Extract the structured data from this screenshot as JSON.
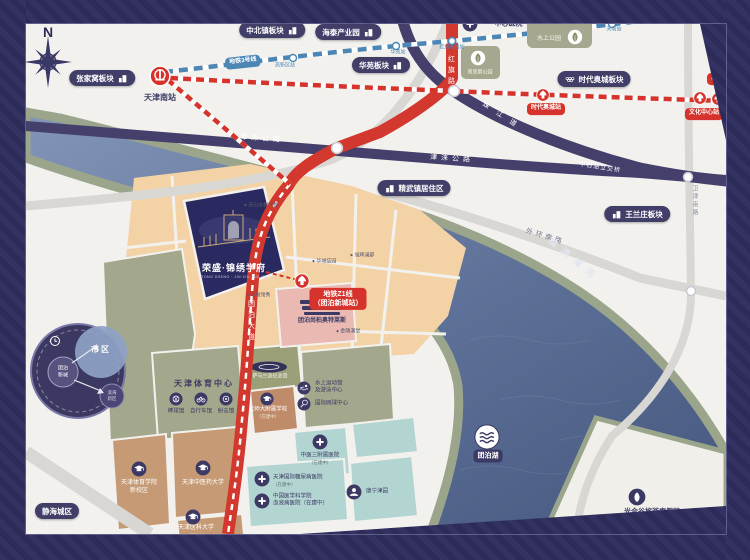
{
  "project": {
    "name": "荣盛·锦绣学府",
    "subtitle": "RONG SHENG · JIN XIU XUE FU"
  },
  "colors": {
    "accent_red": "#d5332b",
    "navy": "#3c3a64",
    "metro_blue": "#4c86b4",
    "parcel_tan": "#f3d3a6",
    "parcel_sage": "#a3a78c",
    "parcel_teal": "#b2d5d2",
    "parcel_brown": "#c59a74",
    "outlet_pink": "#e9b9b2",
    "water": "#5c6f94"
  },
  "pills": [
    {
      "id": "pill-zhangjiawo",
      "t": "张家窝板块",
      "x": 102,
      "y": 78,
      "icon": "building",
      "side": "r"
    },
    {
      "id": "pill-zhongbeizhen",
      "t": "中北镇板块",
      "x": 272,
      "y": 30,
      "icon": "building",
      "side": "r"
    },
    {
      "id": "pill-haitai",
      "t": "海泰产业园",
      "x": 348,
      "y": 32,
      "icon": "building",
      "side": "r"
    },
    {
      "id": "pill-huayuan",
      "t": "华苑板块",
      "x": 381,
      "y": 65,
      "icon": "building",
      "side": "r"
    },
    {
      "id": "pill-shidai-aocheng",
      "t": "时代奥城板块",
      "x": 594,
      "y": 79,
      "icon": "rings",
      "side": "l"
    },
    {
      "id": "pill-jingwuzhen",
      "t": "精武镇居住区",
      "x": 414,
      "y": 188,
      "icon": "building",
      "side": "l"
    },
    {
      "id": "pill-wanglanzhuang",
      "t": "王兰庄板块",
      "x": 637,
      "y": 214,
      "icon": "building",
      "side": "l"
    },
    {
      "id": "pill-jinghai-chengqu",
      "t": "静海城区",
      "x": 57,
      "y": 511,
      "icon": null,
      "side": "l"
    }
  ],
  "badges": [
    {
      "id": "badge-z1-line",
      "lines": [
        "地铁Z1线",
        "（团泊新城站）"
      ],
      "x": 338,
      "y": 299,
      "fs": 7
    },
    {
      "id": "badge-shidai-aocheng-station",
      "lines": [
        "时代奥城站"
      ],
      "x": 546,
      "y": 109,
      "fs": 6
    },
    {
      "id": "badge-wenhua-zhongxin-station",
      "lines": [
        "文化中心站"
      ],
      "x": 704,
      "y": 114,
      "fs": 6
    },
    {
      "id": "badge-tucheng-station",
      "lines": [
        "土城站"
      ],
      "x": 720,
      "y": 79,
      "fs": 6
    },
    {
      "id": "badge-line3",
      "lines": [
        "地铁3号线"
      ],
      "x": 243,
      "y": 62,
      "fs": 6,
      "bg": "#4c86b4",
      "rot": -6
    },
    {
      "id": "badge-tuanbo-lake",
      "lines": [
        "团泊湖"
      ],
      "x": 488,
      "y": 456,
      "fs": 7,
      "bg": "#3c3a64"
    }
  ],
  "labels": [
    {
      "id": "compass-n",
      "t": "N",
      "x": 48,
      "y": 32,
      "fs": 14,
      "c": "#2f2d58",
      "b": 1
    },
    {
      "id": "tianjin-south-station",
      "t": "天津南站",
      "x": 160,
      "y": 98,
      "fs": 8,
      "c": "#3c3a64",
      "b": 1
    },
    {
      "id": "road-jinlai-1",
      "t": "津涞公路",
      "x": 262,
      "y": 139,
      "fs": 7,
      "c": "#ffffff",
      "rot": 4,
      "ls": 4
    },
    {
      "id": "road-jinlai-2",
      "t": "津涞公路",
      "x": 452,
      "y": 159,
      "fs": 7,
      "c": "#ffffff",
      "rot": 4,
      "ls": 4
    },
    {
      "id": "road-zhujiang",
      "t": "珠江道",
      "x": 503,
      "y": 117,
      "fs": 7,
      "c": "#ffffff",
      "rot": 33,
      "ls": 9
    },
    {
      "id": "road-hongqi",
      "t": "红旗路",
      "x": 451,
      "y": 55,
      "fs": 7,
      "c": "#ffffff",
      "v": 1,
      "ls": 4
    },
    {
      "id": "road-tuanbo-dadao",
      "t": "团泊大道",
      "x": 251,
      "y": 300,
      "fs": 7,
      "c": "#ffffff",
      "v": 1,
      "ls": 4
    },
    {
      "id": "bridge-zhongshiyou",
      "t": "中石油立交桥",
      "x": 600,
      "y": 168,
      "fs": 6,
      "c": "#ffffff",
      "rot": 9,
      "ls": 1
    },
    {
      "id": "road-waihuan-south",
      "t": "外环南路",
      "x": 545,
      "y": 237,
      "fs": 7,
      "c": "#73738a",
      "rot": 17,
      "ls": 3
    },
    {
      "id": "road-weijin-south",
      "t": "卫津南路",
      "x": 694,
      "y": 185,
      "fs": 6,
      "c": "#9093a0",
      "v": 1,
      "ls": 2
    },
    {
      "id": "river-duliujian",
      "t": "独流减河",
      "x": 574,
      "y": 260,
      "fs": 9,
      "c": "#e2e6f2",
      "rot": 40,
      "ls": 7,
      "b": 1
    },
    {
      "id": "hospital-yizhongxin",
      "t": "一中心医院",
      "x": 505,
      "y": 24,
      "fs": 7,
      "c": "#3c3a64",
      "b": 1
    },
    {
      "id": "park-shuishang",
      "t": "水上公园",
      "x": 549,
      "y": 39,
      "fs": 6,
      "c": "#f5f5ea"
    },
    {
      "id": "park-nancuiping",
      "t": "南翠屏公园",
      "x": 480,
      "y": 73,
      "fs": 5,
      "c": "#f5f5ea"
    },
    {
      "id": "station-gaoxinqu",
      "t": "高新区站",
      "x": 285,
      "y": 66,
      "fs": 5,
      "c": "#4c86b4"
    },
    {
      "id": "station-huayuan",
      "t": "华苑站",
      "x": 398,
      "y": 53,
      "fs": 5,
      "c": "#4c86b4"
    },
    {
      "id": "station-hongqinanlu",
      "t": "红旗南路站",
      "x": 452,
      "y": 48,
      "fs": 5,
      "c": "#4c86b4"
    },
    {
      "id": "station-tianta",
      "t": "天塔站",
      "x": 614,
      "y": 30,
      "fs": 5,
      "c": "#4c86b4"
    },
    {
      "id": "community-1",
      "t": "● 天山水榭花都",
      "x": 244,
      "y": 206,
      "fs": 5,
      "c": "#5c5c6e",
      "a": 1
    },
    {
      "id": "community-2",
      "t": "● 华城佶园",
      "x": 312,
      "y": 262,
      "fs": 5,
      "c": "#5c5c6e",
      "a": 1
    },
    {
      "id": "community-3",
      "t": "● 旭辉澜郡",
      "x": 350,
      "y": 256,
      "fs": 5,
      "c": "#5c5c6e",
      "a": 1
    },
    {
      "id": "community-4",
      "t": "● 华城领秀",
      "x": 246,
      "y": 296,
      "fs": 5,
      "c": "#5c5c6e",
      "a": 1
    },
    {
      "id": "community-5",
      "t": "● 金隅满堂",
      "x": 336,
      "y": 332,
      "fs": 5,
      "c": "#5c5c6e",
      "a": 1
    },
    {
      "id": "sports-center-title",
      "t": "天津体育中心",
      "x": 204,
      "y": 384,
      "fs": 8,
      "c": "#3c3a64",
      "b": 1,
      "ls": 2
    },
    {
      "id": "venue-baseball",
      "t": "棒球馆",
      "x": 176,
      "y": 412,
      "fs": 5.5,
      "c": "#3c3a64"
    },
    {
      "id": "venue-cycling",
      "t": "自行车馆",
      "x": 201,
      "y": 412,
      "fs": 5.5,
      "c": "#3c3a64"
    },
    {
      "id": "venue-shooting",
      "t": "射击馆",
      "x": 226,
      "y": 412,
      "fs": 5.5,
      "c": "#3c3a64"
    },
    {
      "id": "venue-samaranch",
      "t": "萨马兰奇纪念馆",
      "x": 270,
      "y": 377,
      "fs": 5,
      "c": "#f2f2ea"
    },
    {
      "id": "venue-aquatic-1",
      "t": "水上运动馆",
      "x": 315,
      "y": 384,
      "fs": 5.5,
      "c": "#3c3a64",
      "a": 1
    },
    {
      "id": "venue-aquatic-2",
      "t": "及游泳中心",
      "x": 315,
      "y": 391,
      "fs": 5.5,
      "c": "#3c3a64",
      "a": 1
    },
    {
      "id": "venue-tennis",
      "t": "国际网球中心",
      "x": 315,
      "y": 404,
      "fs": 5.5,
      "c": "#3c3a64",
      "a": 1
    },
    {
      "id": "school-beishida",
      "t": "北师大附属学校",
      "x": 268,
      "y": 410,
      "fs": 5.5,
      "c": "#ffffff"
    },
    {
      "id": "school-beishida-note",
      "t": "（在建中）",
      "x": 268,
      "y": 417,
      "fs": 4.5,
      "c": "#f0e6da"
    },
    {
      "id": "outlet-label",
      "t": "团泊尚柏奥特莱斯",
      "x": 322,
      "y": 321,
      "fs": 6,
      "c": "#3c3a64",
      "b": 1
    },
    {
      "id": "hospital-zhongyi-3",
      "t": "中医三附属医院",
      "x": 320,
      "y": 456,
      "fs": 5.5,
      "c": "#3c3a64"
    },
    {
      "id": "hospital-zhongyi-3-note",
      "t": "（在建中）",
      "x": 320,
      "y": 463,
      "fs": 4.5,
      "c": "#5d6e76"
    },
    {
      "id": "hospital-tangniaobing",
      "t": "天津国际糖尿病医院",
      "x": 273,
      "y": 478,
      "fs": 5.5,
      "c": "#3c3a64",
      "a": 1
    },
    {
      "id": "hospital-tangniaobing-note",
      "t": "（在建中）",
      "x": 273,
      "y": 485,
      "fs": 4.5,
      "c": "#5d6e76",
      "a": 1
    },
    {
      "id": "hospital-xueyebing-1",
      "t": "中国医学科学院",
      "x": 273,
      "y": 497,
      "fs": 5.5,
      "c": "#3c3a64",
      "a": 1
    },
    {
      "id": "hospital-xueyebing-2",
      "t": "血液病医院（在建中）",
      "x": 273,
      "y": 504,
      "fs": 5.5,
      "c": "#3c3a64",
      "a": 1
    },
    {
      "id": "kangning-jinyuan",
      "t": "康宁津园",
      "x": 366,
      "y": 492,
      "fs": 5.5,
      "c": "#3c3a64",
      "a": 1
    },
    {
      "id": "univ-tiyu-1",
      "t": "天津体育学院",
      "x": 139,
      "y": 483,
      "fs": 6,
      "c": "#ffffff"
    },
    {
      "id": "univ-tiyu-2",
      "t": "新校区",
      "x": 139,
      "y": 491,
      "fs": 6,
      "c": "#ffffff"
    },
    {
      "id": "univ-zhongyiyao",
      "t": "天津中医药大学",
      "x": 203,
      "y": 483,
      "fs": 6,
      "c": "#ffffff"
    },
    {
      "id": "univ-yike",
      "t": "天津医科大学",
      "x": 196,
      "y": 528,
      "fs": 6,
      "c": "#ffffff"
    },
    {
      "id": "univ-yike-note",
      "t": "（规划中）",
      "x": 196,
      "y": 536,
      "fs": 4.5,
      "c": "#efe6dc"
    },
    {
      "id": "guanghegu",
      "t": "光合谷旅游度假区",
      "x": 652,
      "y": 512,
      "fs": 7,
      "c": "#3c3a64",
      "b": 1
    },
    {
      "id": "inset-shiqu",
      "t": "市区",
      "x": 101,
      "y": 350,
      "fs": 8,
      "c": "#ffffff",
      "b": 1,
      "ls": 2
    },
    {
      "id": "inset-tuanbo-1",
      "t": "团泊",
      "x": 63,
      "y": 369,
      "fs": 5,
      "c": "#ffffff"
    },
    {
      "id": "inset-tuanbo-2",
      "t": "新城",
      "x": 63,
      "y": 376,
      "fs": 5,
      "c": "#ffffff"
    },
    {
      "id": "inset-binhai-1",
      "t": "滨海",
      "x": 112,
      "y": 393,
      "fs": 4.5,
      "c": "#dcdcea"
    },
    {
      "id": "inset-binhai-2",
      "t": "新区",
      "x": 112,
      "y": 399,
      "fs": 4.5,
      "c": "#dcdcea"
    }
  ],
  "pois": [
    {
      "id": "tianjin-south-railway-icon",
      "icon": "rail",
      "x": 160,
      "y": 76,
      "r": 11
    },
    {
      "id": "z1-tuanbo-station-icon",
      "icon": "metro",
      "x": 302,
      "y": 281,
      "r": 8
    },
    {
      "id": "aocheng-station-icon",
      "icon": "metro",
      "x": 543,
      "y": 95,
      "r": 7
    },
    {
      "id": "wenhua-station-icon",
      "icon": "metro",
      "x": 700,
      "y": 98,
      "r": 7
    },
    {
      "id": "tucheng-station-icon",
      "icon": "metro",
      "x": 718,
      "y": 99,
      "r": 7
    },
    {
      "id": "yizhongxin-hospital-icon",
      "icon": "cross",
      "x": 470,
      "y": 24,
      "r": 8
    },
    {
      "id": "shuishang-park-icon",
      "icon": "leaf",
      "x": 575,
      "y": 37,
      "r": 8
    },
    {
      "id": "nancuiping-park-icon",
      "icon": "leaf",
      "x": 478,
      "y": 58,
      "r": 8
    },
    {
      "id": "zhongyi3-hospital-icon",
      "icon": "cross",
      "x": 320,
      "y": 442,
      "r": 8
    },
    {
      "id": "tangniaobing-hospital-icon",
      "icon": "cross",
      "x": 262,
      "y": 479,
      "r": 8
    },
    {
      "id": "xueyebing-hospital-icon",
      "icon": "cross",
      "x": 262,
      "y": 501,
      "r": 8
    },
    {
      "id": "kangning-icon",
      "icon": "person",
      "x": 354,
      "y": 492,
      "r": 8
    },
    {
      "id": "univ-tiyu-icon",
      "icon": "cap",
      "x": 139,
      "y": 469,
      "r": 8
    },
    {
      "id": "univ-zhongyiyao-icon",
      "icon": "cap",
      "x": 203,
      "y": 468,
      "r": 8
    },
    {
      "id": "univ-yike-icon",
      "icon": "cap",
      "x": 193,
      "y": 517,
      "r": 8
    },
    {
      "id": "school-beishida-icon",
      "icon": "cap",
      "x": 267,
      "y": 399,
      "r": 7
    },
    {
      "id": "baseball-icon",
      "icon": "ball",
      "x": 176,
      "y": 399,
      "r": 7
    },
    {
      "id": "cycling-icon",
      "icon": "bike",
      "x": 201,
      "y": 399,
      "r": 7
    },
    {
      "id": "shooting-icon",
      "icon": "target",
      "x": 226,
      "y": 399,
      "r": 7
    },
    {
      "id": "aquatic-icon",
      "icon": "swim",
      "x": 304,
      "y": 388,
      "r": 7
    },
    {
      "id": "tennis-icon",
      "icon": "racket",
      "x": 304,
      "y": 404,
      "r": 7
    },
    {
      "id": "tuanbo-lake-icon",
      "icon": "waves",
      "x": 487,
      "y": 437,
      "r": 13
    },
    {
      "id": "guanghegu-icon",
      "icon": "leafNavy",
      "x": 637,
      "y": 497,
      "r": 9
    }
  ]
}
